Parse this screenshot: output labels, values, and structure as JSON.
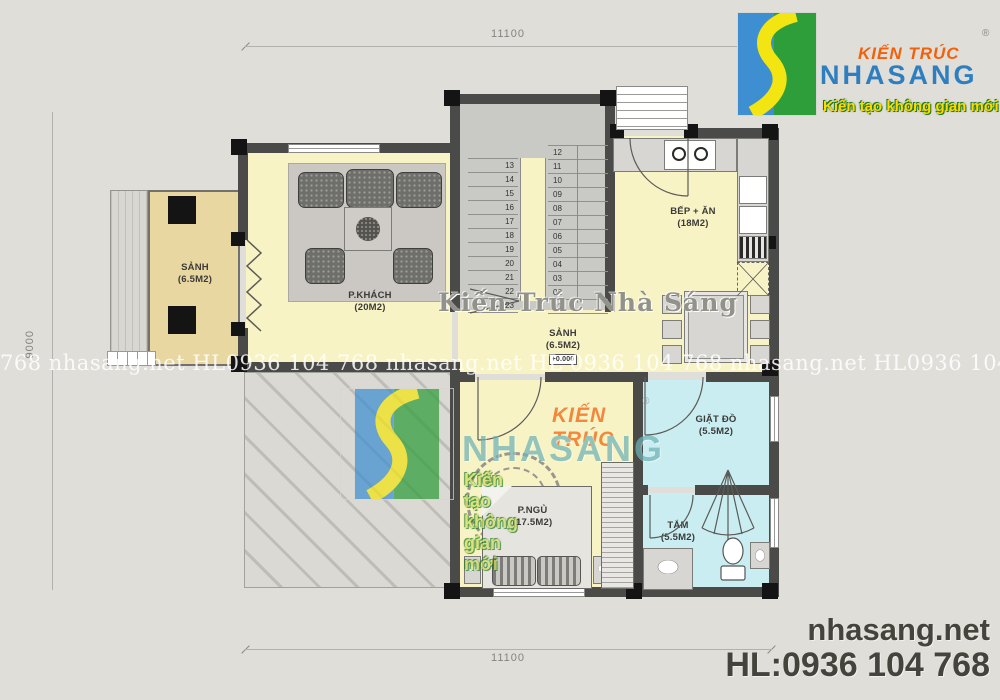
{
  "dimensions": {
    "top": "11100",
    "bottom": "11100",
    "left": "9000"
  },
  "rooms": {
    "porch": {
      "name": "SẢNH",
      "area": "(6.5M2)"
    },
    "living": {
      "name": "P.KHÁCH",
      "area": "(20M2)"
    },
    "kitchen": {
      "name": "BẾP + ĂN",
      "area": "(18M2)"
    },
    "hall": {
      "name": "SẢNH",
      "area": "(6.5M2)",
      "level": "+0.000"
    },
    "laundry": {
      "name": "GIẶT ĐỒ",
      "area": "(5.5M2)"
    },
    "bedroom": {
      "name": "P.NGỦ",
      "area": "(17.5M2)"
    },
    "bath": {
      "name": "TẮM",
      "area": "(5.5M2)"
    }
  },
  "stairs": {
    "left_flight": [
      "13",
      "14",
      "15",
      "16",
      "17",
      "18",
      "19",
      "20",
      "21",
      "22",
      "23"
    ],
    "right_flight": [
      "12",
      "11",
      "10",
      "09",
      "08",
      "07",
      "06",
      "05",
      "04",
      "03",
      "02",
      "01"
    ]
  },
  "brand": {
    "kien_truc": "KIẾN TRÚC",
    "registered": "®",
    "name": "NHASANG",
    "tagline": "Kiến tạo không gian mới",
    "colors": {
      "kien_truc_orange": "#f2600a",
      "name_blue": "#2f7fc0",
      "tagline_yellow": "#ffd900",
      "logo_blue": "#3d8fd1",
      "logo_green": "#2e9e3a",
      "logo_yellow": "#f3e512",
      "center_name_teal": "#6fb3b5"
    }
  },
  "watermarks": {
    "row": "768 nhasang.net HL0936 104 768 nhasang.net HL 0936 104 768 nhasang.net HL0936 104 768 nhasang.net HL",
    "center_title": "Kiến Trúc Nhà Sáng"
  },
  "footer": {
    "website": "nhasang.net",
    "hotline": "HL:0936 104 768",
    "text_color": "#45443c"
  }
}
